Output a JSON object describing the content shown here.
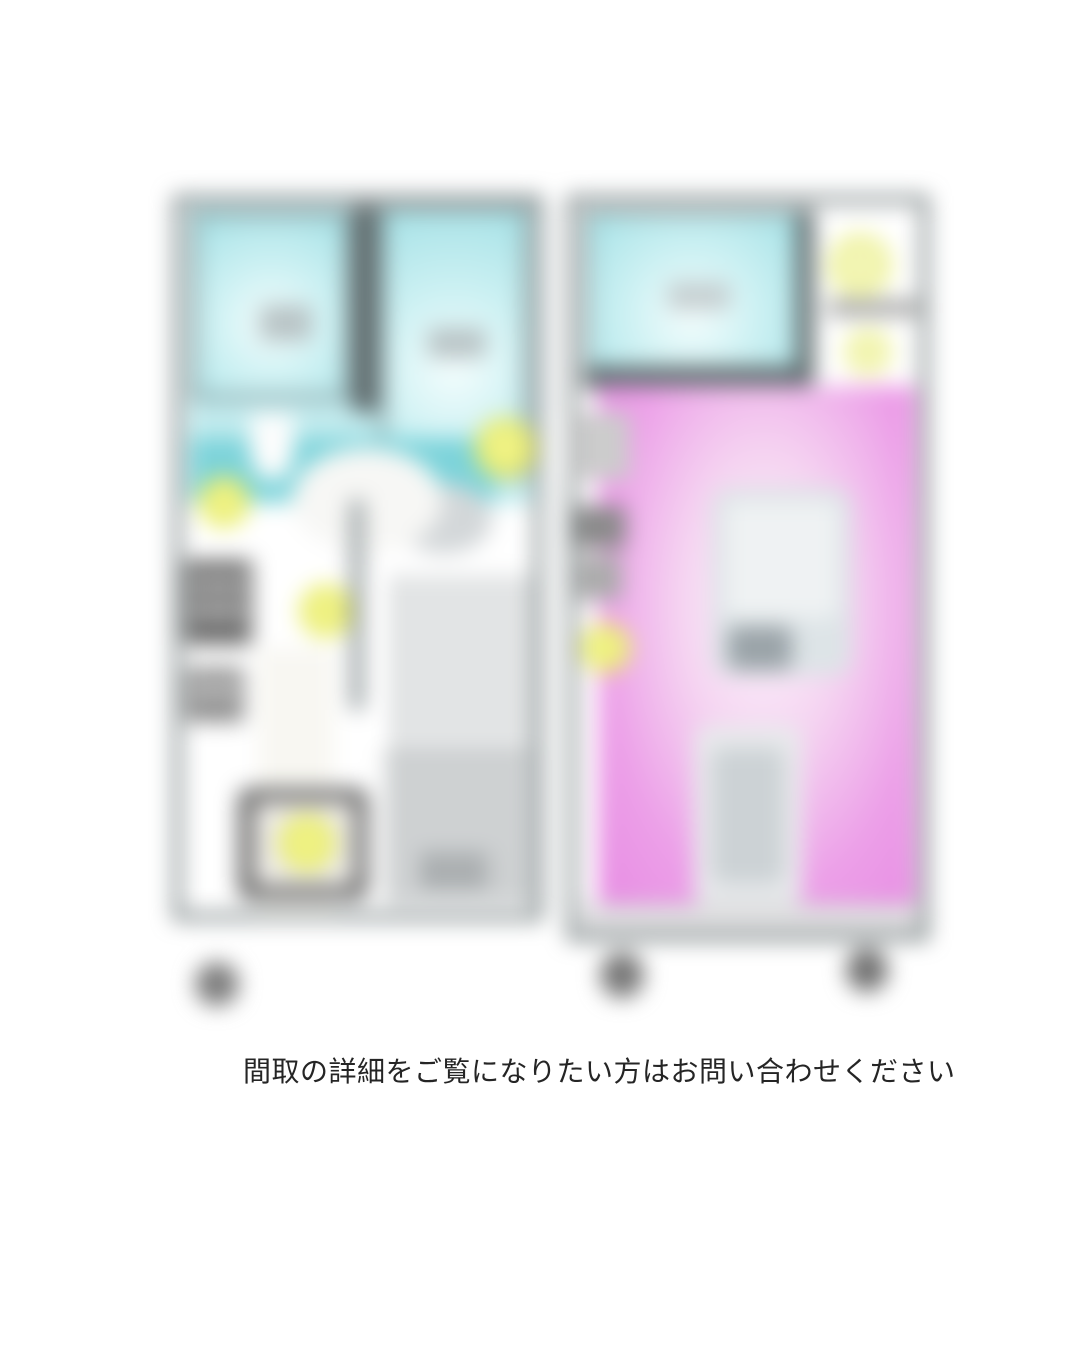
{
  "caption": {
    "text": "間取の詳細をご覧になりたい方はお問い合わせください"
  },
  "colors": {
    "page_bg": "#ffffff",
    "wall_grey": "#5f6b6d",
    "cyan_edge": "#a5e1e6",
    "cyan_light": "#f4fdfd",
    "teal_band": "#7cd3da",
    "pink_edge": "#e78ce3",
    "pink_light": "#fdf6fd",
    "highlight_yellow": "#e9ed6a",
    "highlight_yellow_pale": "#eef2a0",
    "text_color": "#252525"
  }
}
